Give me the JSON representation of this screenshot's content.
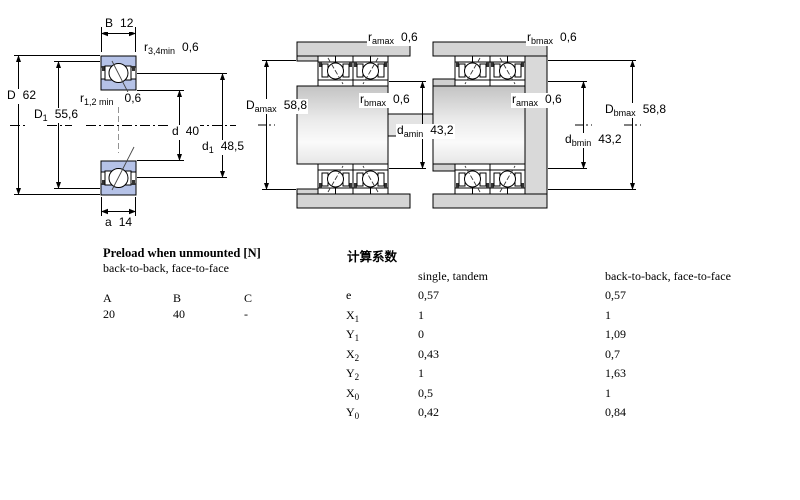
{
  "drawing": {
    "left": {
      "B": {
        "base": "B",
        "sub": "",
        "value": "12"
      },
      "r34": {
        "base": "r",
        "sub": "3,4min",
        "value": "0,6"
      },
      "r12": {
        "base": "r",
        "sub": "1,2 min",
        "value": "0,6"
      },
      "D": {
        "base": "D",
        "sub": "",
        "value": "62"
      },
      "D1": {
        "base": "D",
        "sub": "1",
        "value": "55,6"
      },
      "d": {
        "base": "d",
        "sub": "",
        "value": "40"
      },
      "d1": {
        "base": "d",
        "sub": "1",
        "value": "48,5"
      },
      "a": {
        "base": "a",
        "sub": "",
        "value": "14"
      }
    },
    "pair_a": {
      "r_amax": {
        "base": "r",
        "sub": "amax",
        "value": "0,6"
      },
      "r_bmax": {
        "base": "r",
        "sub": "bmax",
        "value": "0,6"
      },
      "D_amax": {
        "base": "D",
        "sub": "amax",
        "value": "58,8"
      },
      "d_amin": {
        "base": "d",
        "sub": "amin",
        "value": "43,2"
      }
    },
    "pair_b": {
      "r_bmax": {
        "base": "r",
        "sub": "bmax",
        "value": "0,6"
      },
      "r_amax": {
        "base": "r",
        "sub": "amax",
        "value": "0,6"
      },
      "d_bmin": {
        "base": "d",
        "sub": "bmin",
        "value": "43,2"
      },
      "D_bmax": {
        "base": "D",
        "sub": "bmax",
        "value": "58,8"
      }
    }
  },
  "preload": {
    "title": "Preload when unmounted [N]",
    "subtitle": "back-to-back, face-to-face",
    "col_a": "A",
    "col_b": "B",
    "col_c": "C",
    "val_a": "20",
    "val_b": "40",
    "val_c": "-"
  },
  "factors": {
    "title": "计算系数",
    "header_single": "single, tandem",
    "header_btb": "back-to-back, face-to-face",
    "rows": [
      {
        "base": "e",
        "sub": "",
        "single": "0,57",
        "btb": "0,57"
      },
      {
        "base": "X",
        "sub": "1",
        "single": "1",
        "btb": "1"
      },
      {
        "base": "Y",
        "sub": "1",
        "single": "0",
        "btb": "1,09"
      },
      {
        "base": "X",
        "sub": "2",
        "single": "0,43",
        "btb": "0,7"
      },
      {
        "base": "Y",
        "sub": "2",
        "single": "1",
        "btb": "1,63"
      },
      {
        "base": "X",
        "sub": "0",
        "single": "0,5",
        "btb": "1"
      },
      {
        "base": "Y",
        "sub": "0",
        "single": "0,42",
        "btb": "0,84"
      }
    ]
  },
  "colors": {
    "ring_blue": "#b5c2e7",
    "housing_gray": "#d4d4d4",
    "steel_light": "#e3e3e3"
  }
}
